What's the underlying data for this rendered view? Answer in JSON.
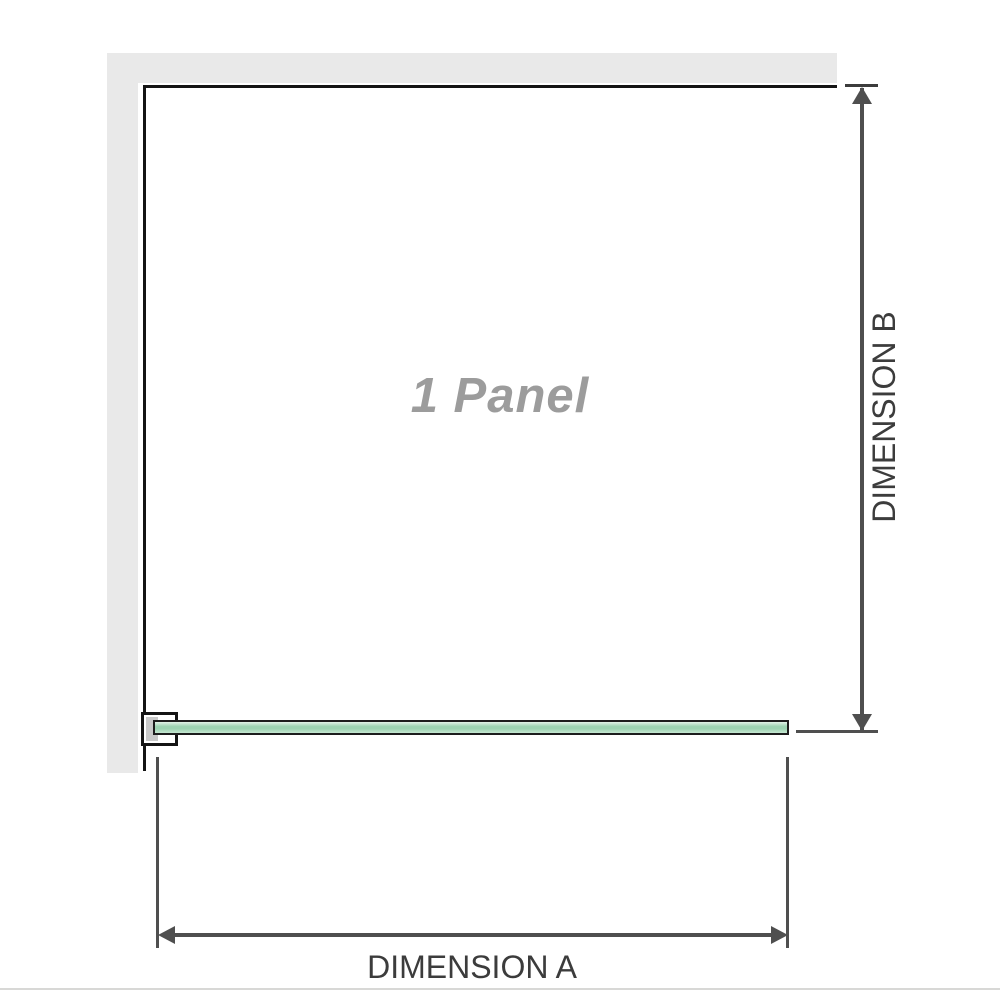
{
  "labels": {
    "panel": "1 Panel",
    "dimension_a": "DIMENSION A",
    "dimension_b": "DIMENSION B"
  },
  "colors": {
    "wall": "#e9e9e9",
    "panel-border": "#141414",
    "panel-text": "#9c9c9c",
    "dim-line": "#4f4f4f",
    "dim-text": "#3c3c3c",
    "glass-border": "#1d1d1d",
    "glass-light": "#e3f2e8",
    "glass-mid": "#9dd3b2",
    "glass-lower": "#c6e7d2",
    "bracket-pad": "#c9c9c9",
    "divider": "#d8d8d6"
  }
}
